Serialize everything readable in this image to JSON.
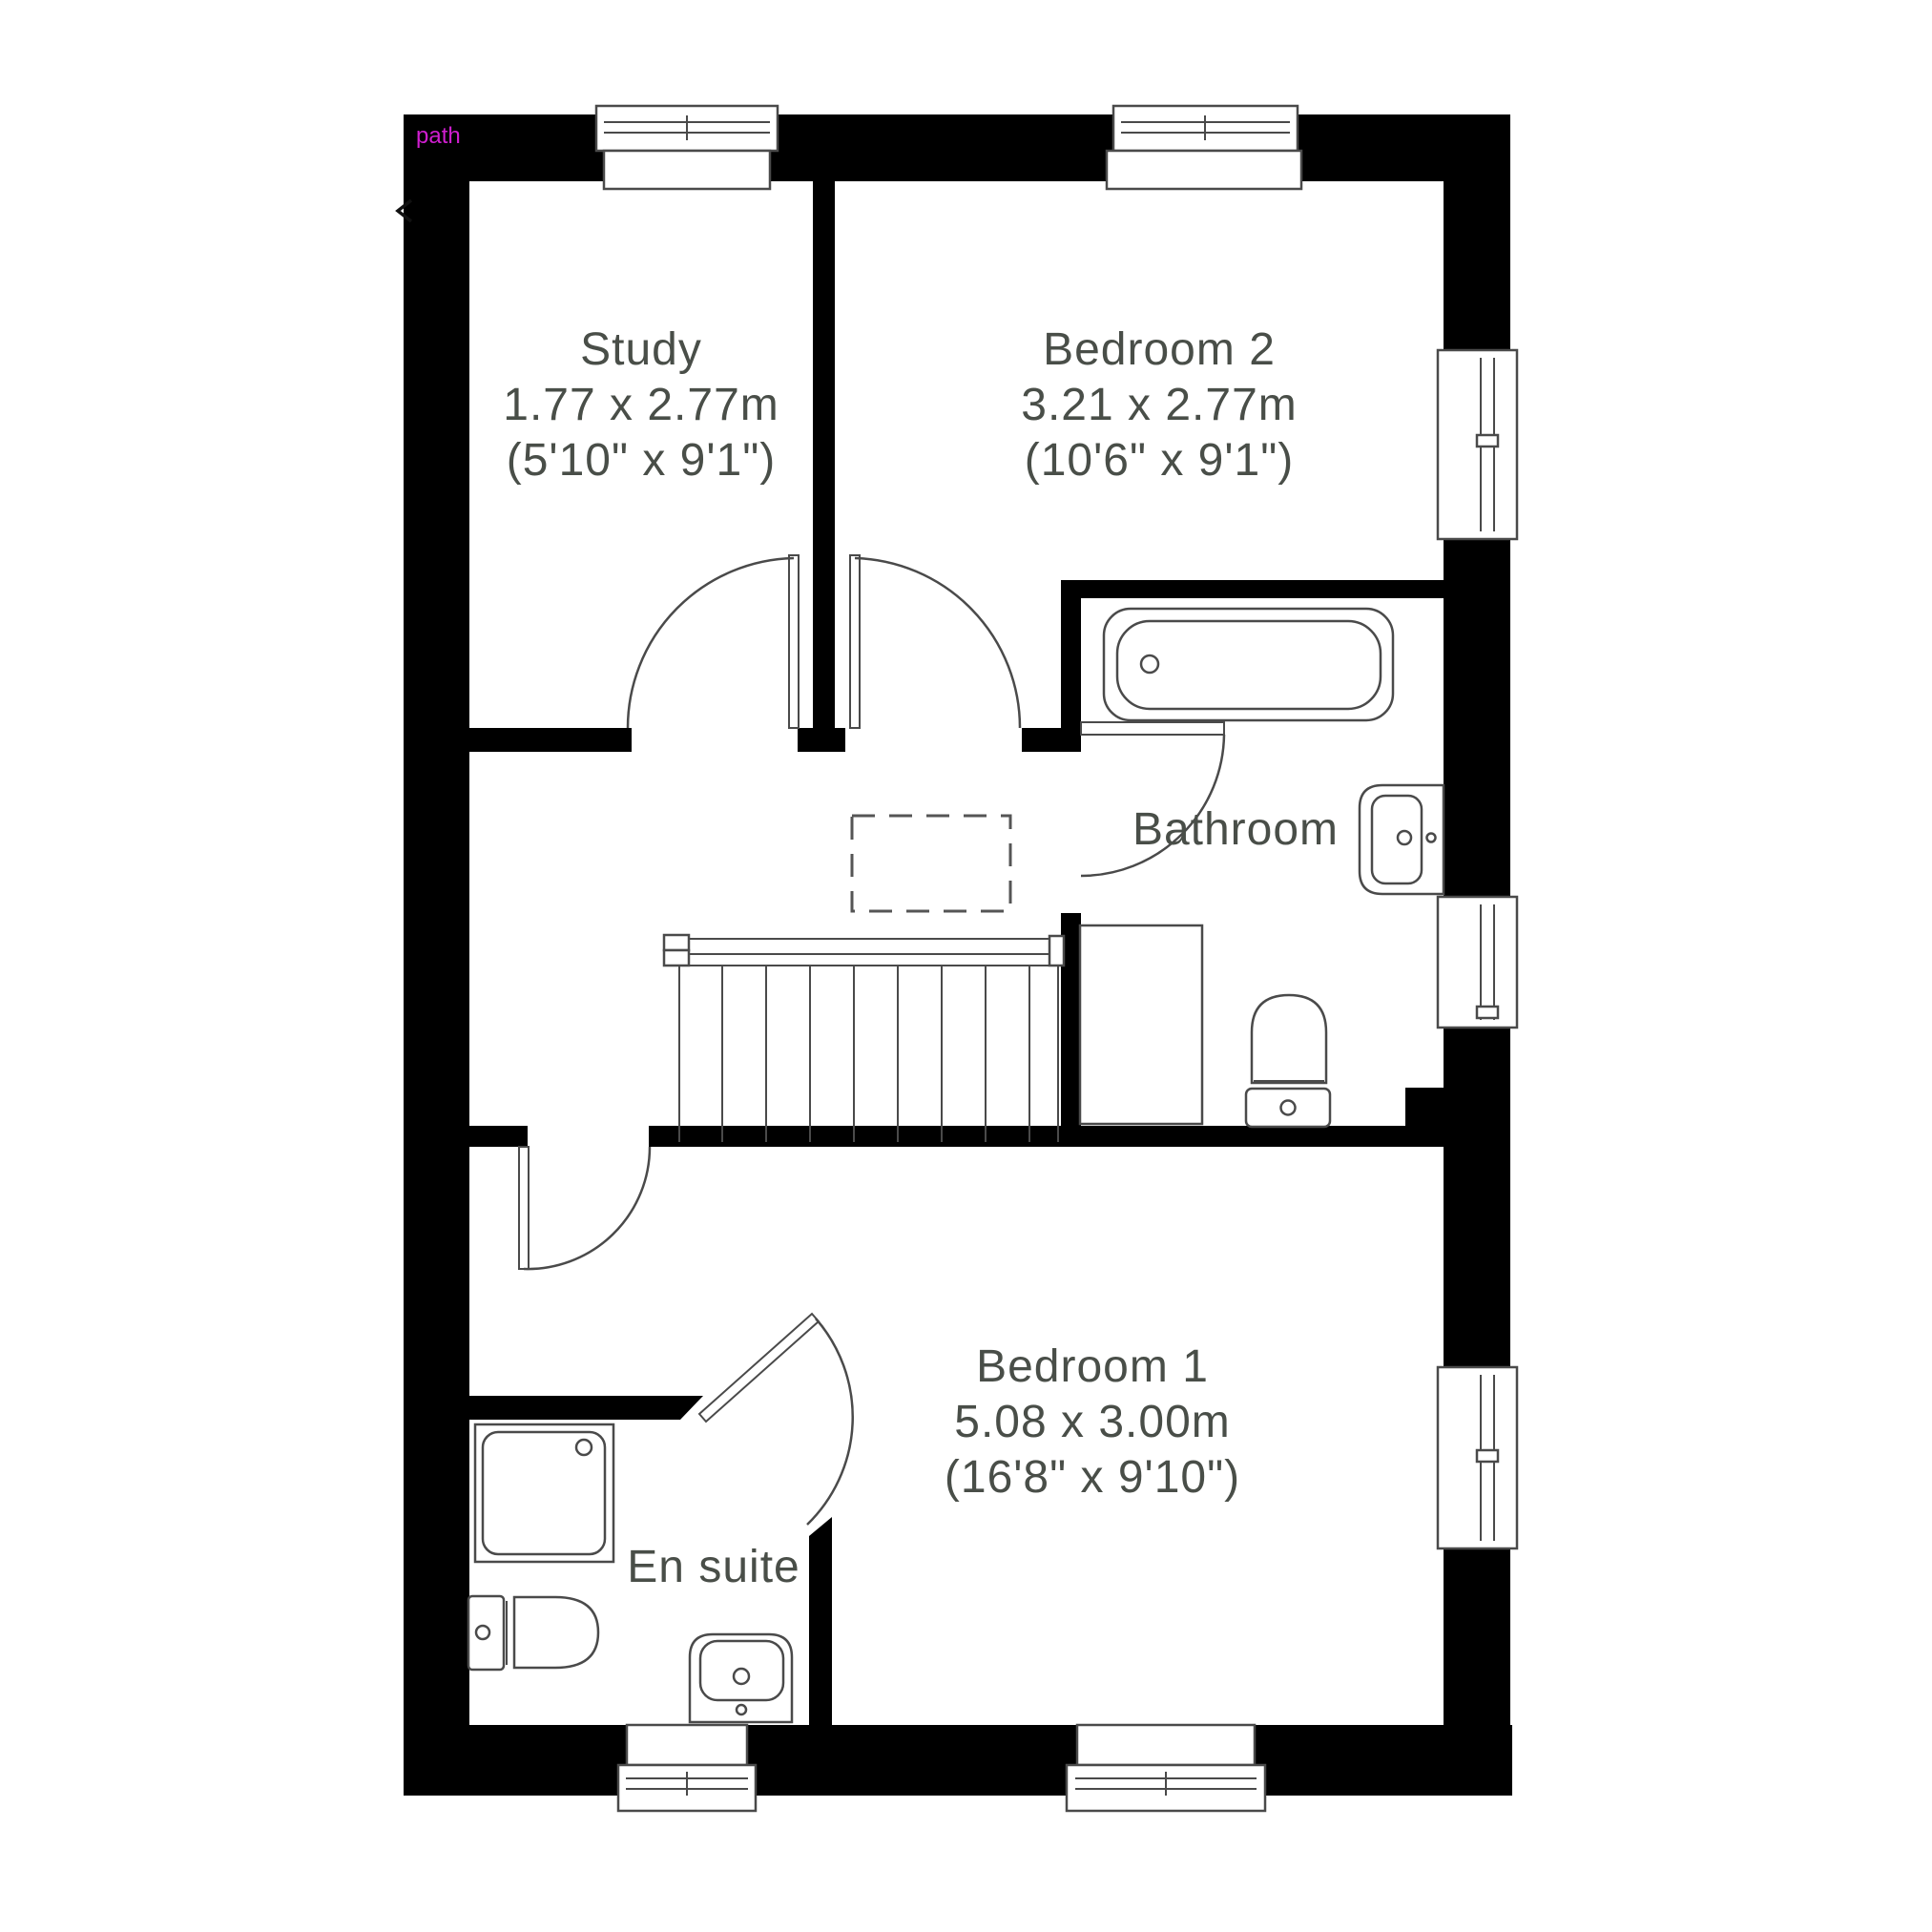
{
  "plan": {
    "overlay": {
      "path_label": "path"
    },
    "rooms": [
      {
        "name": "Study",
        "size_metric": "1.77 x 2.77m",
        "size_imperial": "(5'10\" x 9'1\")"
      },
      {
        "name": "Bedroom 2",
        "size_metric": "3.21 x 2.77m",
        "size_imperial": "(10'6\" x 9'1\")"
      },
      {
        "name": "Bathroom"
      },
      {
        "name": "Bedroom 1",
        "size_metric": "5.08 x 3.00m",
        "size_imperial": "(16'8\" x 9'10\")"
      },
      {
        "name": "En suite"
      }
    ],
    "colors": {
      "wall": "#000000",
      "fixture_line": "#4a4a4a",
      "label_text": "#494e48",
      "path_label": "#cf1ecf",
      "background": "#ffffff"
    }
  }
}
